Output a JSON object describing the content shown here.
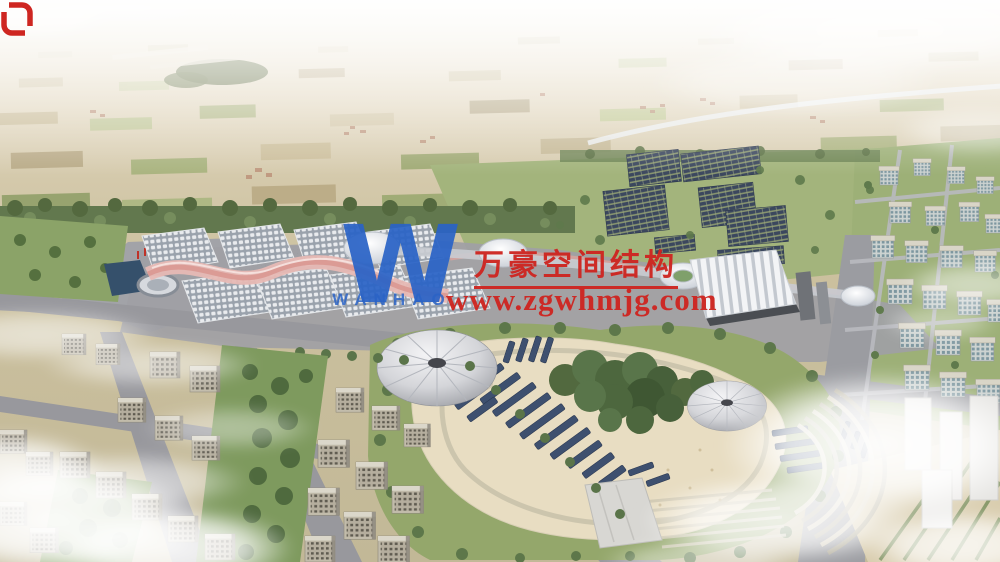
{
  "page": {
    "kind": "aerial architectural rendering",
    "description": "Bird's-eye rendering of the Wanhao exhibition-center campus: rows of pillow-clad exhibition halls joined by a pink membrane ribbon, a pleated white standard hall, dark solar-panel farms, a landscaped park with two conical tent canopies and panel rows, residential city blocks on both sides, and patchwork farmland stretching to a hazy horizon with drifting clouds."
  },
  "watermark": {
    "logo_letter": "W",
    "logo_caption": "WANHAO",
    "company_name_cn": "万豪空间结构",
    "website": "www.zgwhmjg.com",
    "colors": {
      "red": "#ce2621",
      "blue": "#2a63c6"
    }
  },
  "palette": {
    "sky_haze": "#f4f0e7",
    "farmland_tan": "#d3c8ab",
    "farmland_green": "#aab67f",
    "forest_green": "#5d774a",
    "hall_roof_gray": "#9aa2ac",
    "membrane_pink": "#e3b2ac",
    "solar_navy": "#3b475e",
    "pavement_gray": "#a0a1a6",
    "park_sand": "#e8ddc2",
    "lawn_green": "#94a76b",
    "canopy_gray": "#b9bcc2",
    "cloud_white": "#ffffff"
  }
}
